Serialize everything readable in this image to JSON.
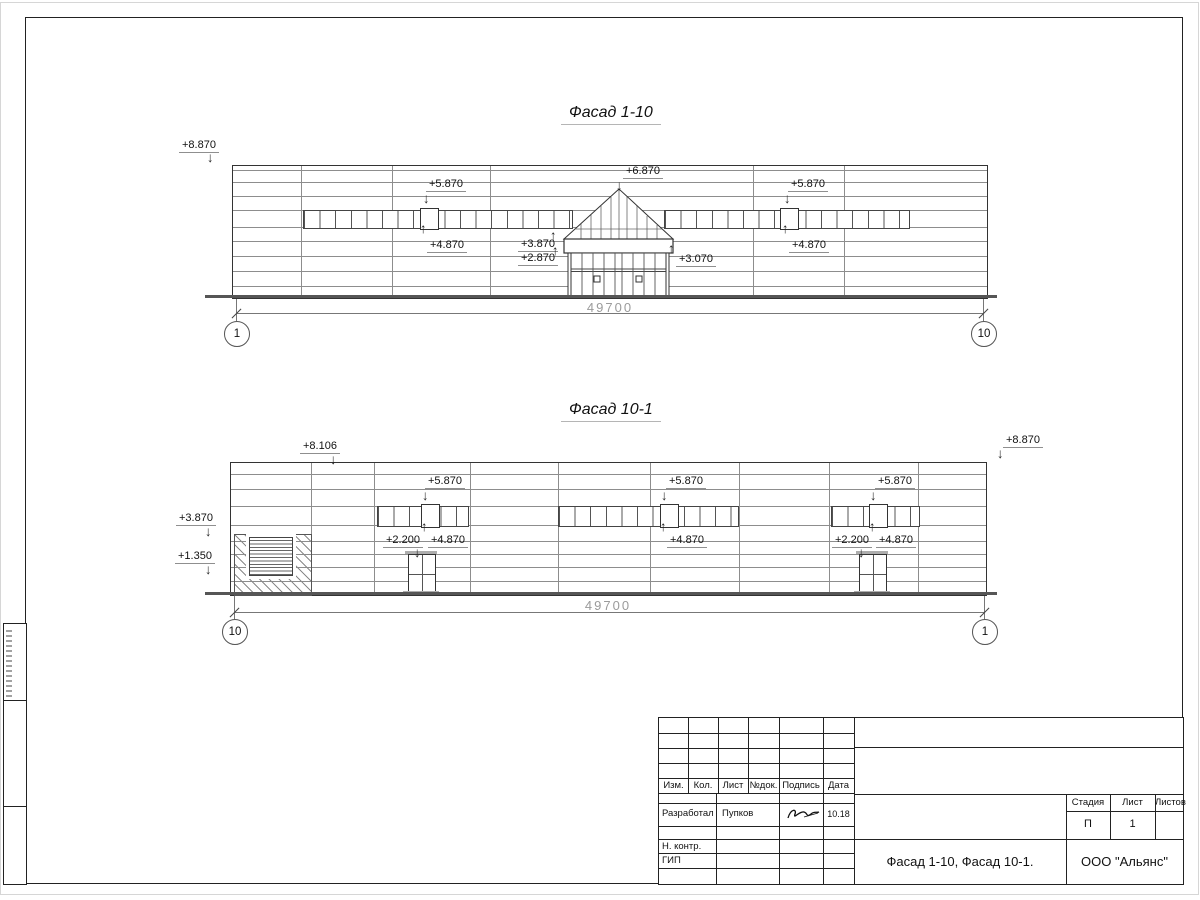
{
  "icons": {
    "arrow_down": "↓",
    "arrow_up": "↑"
  },
  "drawing": {
    "facade_top": {
      "title": "Фасад 1-10",
      "dimension": "49700",
      "axis_left": "1",
      "axis_right": "10",
      "marks": {
        "roof_left": "+8.870",
        "band_left_top": "+5.870",
        "band_left_bottom": "+4.870",
        "entrance_apex": "+6.870",
        "canopy_top": "+3.870",
        "canopy_bottom": "+2.870",
        "canopy_right": "+3.070",
        "band_right_top": "+5.870",
        "band_right_bottom": "+4.870"
      }
    },
    "facade_bottom": {
      "title": "Фасад 10-1",
      "dimension": "49700",
      "axis_left": "10",
      "axis_right": "1",
      "marks": {
        "parapet_left": "+8.106",
        "parapet_right": "+8.870",
        "wall_left_top": "+3.870",
        "wall_left_bottom": "+1.350",
        "band1_top": "+5.870",
        "band1_bottom": "+4.870",
        "door1_top": "+2.200",
        "band2_top": "+5.870",
        "band2_bottom": "+4.870",
        "band3_top": "+5.870",
        "band3_bottom": "+4.870",
        "door2_top": "+2.200"
      }
    },
    "title_block": {
      "columns": {
        "c1": "Изм.",
        "c2": "Кол.",
        "c3": "Лист",
        "c4": "№док.",
        "c5": "Подпись",
        "c6": "Дата"
      },
      "developer_row": {
        "role": "Разработал",
        "name": "Пупков",
        "date": "10.18"
      },
      "ncontr_label": "Н. контр.",
      "gip_label": "ГИП",
      "doc_title": "Фасад 1-10, Фасад 10-1.",
      "company": "ООО \"Альянс\"",
      "stage_label": "Стадия",
      "sheet_label": "Лист",
      "sheets_label": "Листов",
      "stage_value": "П",
      "sheet_value": "1",
      "sheets_value": ""
    }
  }
}
